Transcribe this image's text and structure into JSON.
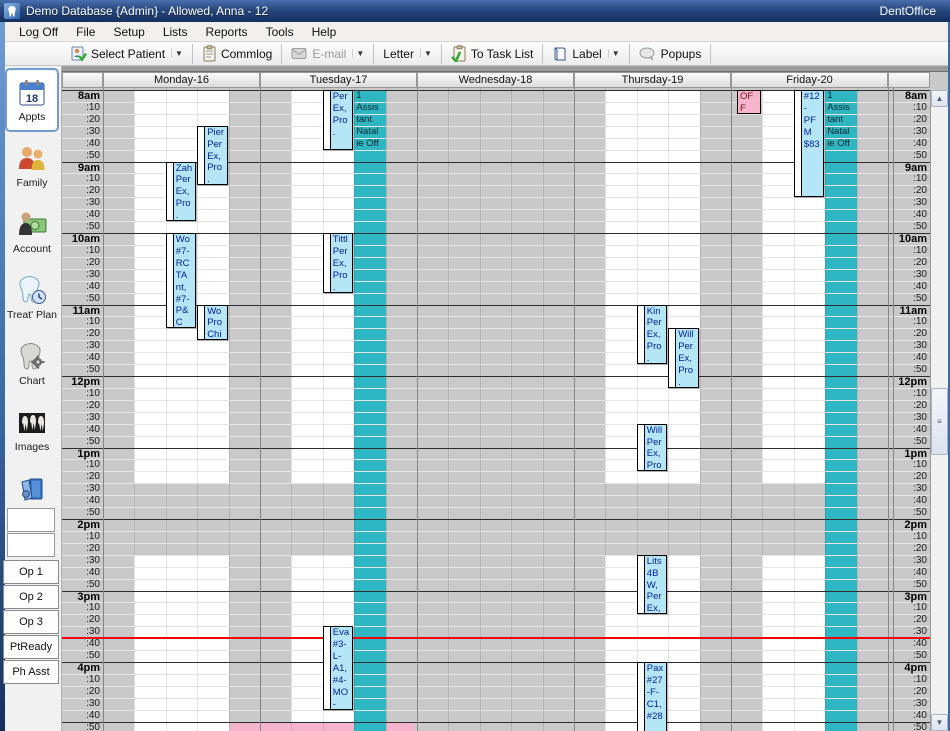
{
  "window": {
    "title": "Demo Database {Admin} - Allowed, Anna - 12",
    "brand": "DentOffice",
    "icon": "tooth-logo-icon"
  },
  "menubar": {
    "items": [
      "Log Off",
      "File",
      "Setup",
      "Lists",
      "Reports",
      "Tools",
      "Help"
    ]
  },
  "toolbar": {
    "buttons": [
      {
        "label": "Select Patient",
        "icon": "select-patient-icon",
        "dropdown": true,
        "disabled": false
      },
      {
        "label": "Commlog",
        "icon": "commlog-icon",
        "dropdown": false,
        "disabled": false
      },
      {
        "label": "E-mail",
        "icon": "email-icon",
        "dropdown": true,
        "disabled": true
      },
      {
        "label": "Letter",
        "icon": null,
        "dropdown": true,
        "disabled": false
      },
      {
        "label": "To Task List",
        "icon": "task-list-icon",
        "dropdown": false,
        "disabled": false
      },
      {
        "label": "Label",
        "icon": "label-icon",
        "dropdown": true,
        "disabled": false
      },
      {
        "label": "Popups",
        "icon": "popups-icon",
        "dropdown": false,
        "disabled": false
      }
    ]
  },
  "sidebar": {
    "modules": [
      {
        "label": "Appts",
        "icon": "appointments-calendar-icon",
        "selected": true,
        "badge": "18"
      },
      {
        "label": "Family",
        "icon": "family-icon",
        "selected": false
      },
      {
        "label": "Account",
        "icon": "account-icon",
        "selected": false
      },
      {
        "label": "Treat' Plan",
        "icon": "treatment-plan-icon",
        "selected": false
      },
      {
        "label": "Chart",
        "icon": "chart-tooth-icon",
        "selected": false
      },
      {
        "label": "Images",
        "icon": "images-xray-icon",
        "selected": false
      },
      {
        "label": "Manage",
        "icon": "manage-icon",
        "selected": false
      }
    ],
    "view_slots": [
      "",
      ""
    ],
    "views": [
      "Op 1",
      "Op 2",
      "Op 3",
      "PtReady",
      "Ph Asst"
    ]
  },
  "schedule": {
    "days": [
      "Monday-16",
      "Tuesday-17",
      "Wednesday-18",
      "Thursday-19",
      "Friday-20"
    ],
    "hours": [
      "8am",
      "9am",
      "10am",
      "11am",
      "12pm",
      "1pm",
      "2pm",
      "3pm",
      "4pm"
    ],
    "minutes": [
      ":10",
      ":20",
      ":30",
      ":40",
      ":50"
    ],
    "open_columns": [
      {
        "day": 0,
        "from": 1,
        "to": 4
      },
      {
        "day": 1,
        "from": 1,
        "to": 3
      },
      {
        "day": 3,
        "from": 1,
        "to": 4
      },
      {
        "day": 4,
        "from": 1,
        "to": 3
      }
    ],
    "closed_band": {
      "start": "13:30",
      "end": "14:30"
    },
    "red_line_time": "15:40",
    "blockout_strips": [
      {
        "day": 1,
        "subcol": 3,
        "label": "1 Assistant Natalie Off",
        "lines": "1\nAssis\ntant\nNatal\nie Off"
      },
      {
        "day": 4,
        "subcol": 3,
        "label": "1 Assistant Natalie Off",
        "lines": "1\nAssis\ntant\nNatal\nie Off"
      }
    ],
    "blockouts": [
      {
        "day": 4,
        "subcol": 0,
        "start": "8:00",
        "end": "8:20",
        "label": "OFF",
        "lines": "OF\nF",
        "color": "pink",
        "dx": 6,
        "w": 26
      }
    ],
    "pink_band": {
      "start": "16:50",
      "x1": 230,
      "x2": 415
    },
    "appointments": [
      {
        "day": 0,
        "subcol": 3,
        "start": "8:30",
        "end": "9:20",
        "lines": "Pier\nPer\nEx,\nPro\n."
      },
      {
        "day": 0,
        "subcol": 2,
        "start": "9:00",
        "end": "9:50",
        "lines": "Zah\nPer\nEx,\nPro\n."
      },
      {
        "day": 0,
        "subcol": 2,
        "start": "10:00",
        "end": "11:20",
        "lines": "Wo\n#7-\nRC\nTA\nnt,\n#7-\nP&\nC"
      },
      {
        "day": 0,
        "subcol": 3,
        "start": "11:00",
        "end": "11:30",
        "lines": "Wo\nPro\nChi"
      },
      {
        "day": 1,
        "subcol": 2,
        "start": "8:00",
        "end": "8:50",
        "lines": "Per\nEx,\nPro\n."
      },
      {
        "day": 1,
        "subcol": 2,
        "start": "10:00",
        "end": "10:50",
        "lines": "Tittl\nPer\nEx,\nPro\n."
      },
      {
        "day": 1,
        "subcol": 2,
        "start": "15:30",
        "end": "16:40",
        "lines": "Eva\n#3-\nL-\nA1,\n#4-\nMO\n-"
      },
      {
        "day": 3,
        "subcol": 2,
        "start": "11:00",
        "end": "11:50",
        "lines": "Kin\nPer\nEx,\nPro\n."
      },
      {
        "day": 3,
        "subcol": 3,
        "start": "11:20",
        "end": "12:10",
        "lines": "Will\nPer\nEx,\nPro\n."
      },
      {
        "day": 3,
        "subcol": 2,
        "start": "12:40",
        "end": "13:20",
        "lines": "Will\nPer\nEx,\nPro\n."
      },
      {
        "day": 3,
        "subcol": 2,
        "start": "14:30",
        "end": "15:20",
        "lines": "Lits\n4B\nW,\nPer\nEx,"
      },
      {
        "day": 3,
        "subcol": 2,
        "start": "16:00",
        "end": "17:00",
        "lines": "Pax\n#27\n-F-\nC1,\n#28"
      },
      {
        "day": 4,
        "subcol": 2,
        "start": "8:00",
        "end": "9:30",
        "lines": "#12\n-\nPF\nM\n$83"
      }
    ],
    "colors": {
      "blocked_gray": "#c9c9c9",
      "open_white": "#ffffff",
      "blockout_teal": "#2eb6c2",
      "appointment_fill": "#b5e6f7",
      "appointment_text": "#001e96",
      "blockout_pink": "#f6b5cc",
      "pink_text": "#7a1020",
      "current_time_red": "#f40000"
    }
  }
}
